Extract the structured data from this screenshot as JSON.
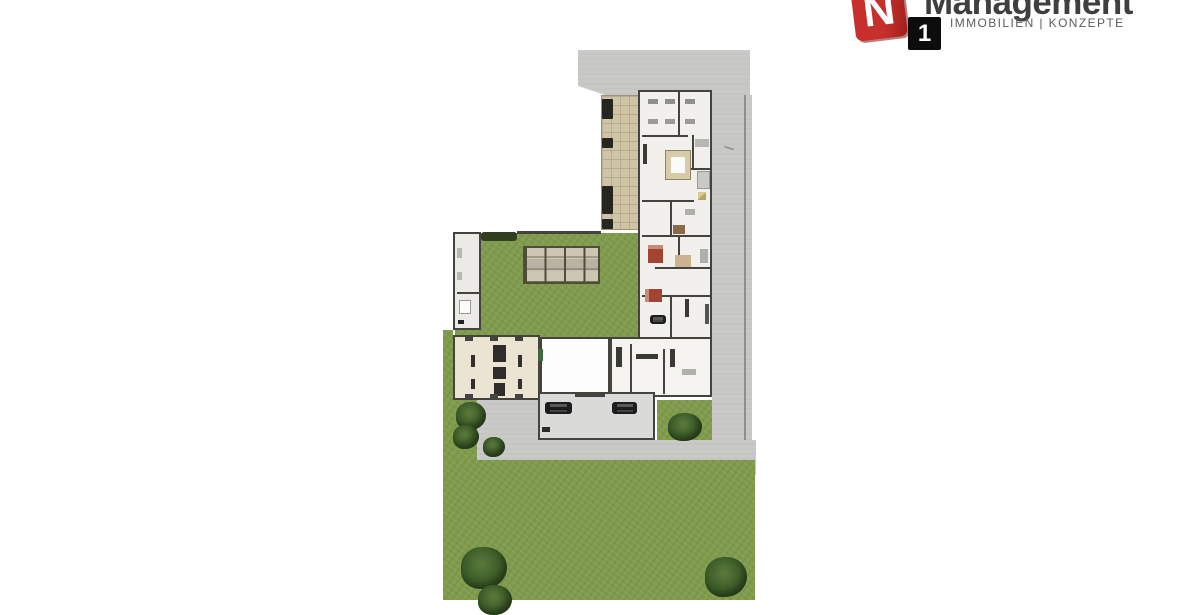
{
  "logo": {
    "n_letter": "N",
    "one_label": "1",
    "brand": "Management",
    "tagline": "IMMOBILIEN | KONZEPTE",
    "colors": {
      "red_square": "#c12a28",
      "black_square": "#0d0d0d",
      "brand_text": "#3f3f3f",
      "tagline_text": "#5c5c5c"
    }
  },
  "plan": {
    "description": "Top-down architectural site plan of an L-shaped property with buildings, courtyard, terrace, garage, roads and lawn",
    "colors": {
      "lawn_green": "#7f9b4c",
      "hedge_green": "#313f20",
      "road_gray": "#c9c9c8",
      "terrace_tan": "#cfc5a6",
      "building_floor": "#f1f0ec",
      "cream_floor": "#ebe4d2",
      "garage_floor": "#dadad8",
      "wall_dark": "#45433e",
      "bed_red": "#a14433",
      "car_black": "#1c1c1c"
    }
  }
}
